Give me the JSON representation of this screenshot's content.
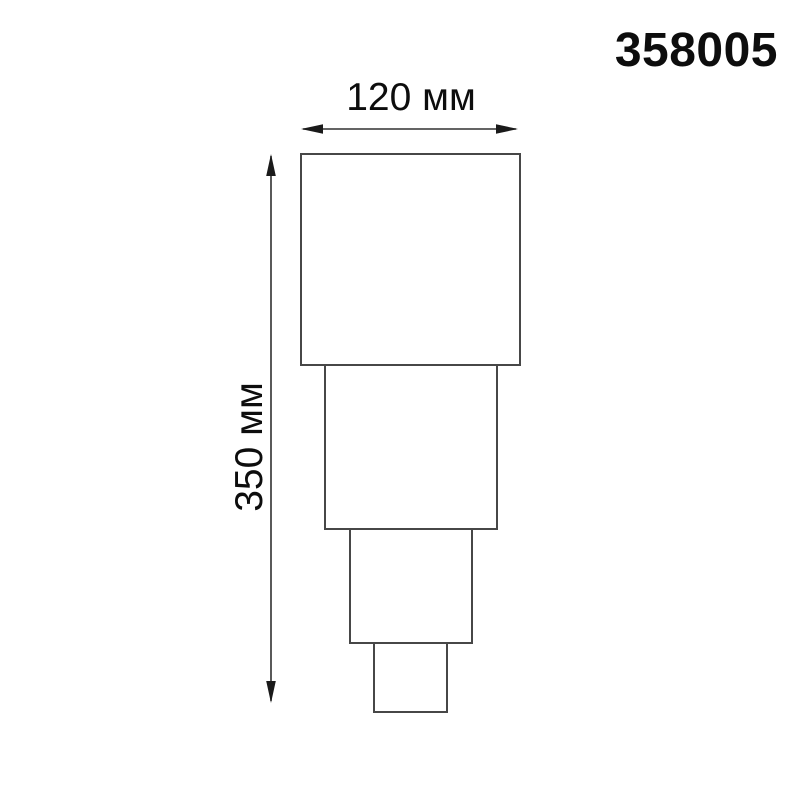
{
  "header": {
    "product_code": "358005"
  },
  "dimensions": {
    "width": {
      "label": "120 мм",
      "value": 120,
      "unit": "мм"
    },
    "height": {
      "label": "350 мм",
      "value": 350,
      "unit": "мм"
    }
  },
  "diagram": {
    "subject": "stepped-luminaire-front-outline",
    "tier_count": 4,
    "colors": {
      "background": "#ffffff",
      "outline": "#474747",
      "dimension_line": "#303030",
      "text": "#0d0d0d"
    }
  }
}
